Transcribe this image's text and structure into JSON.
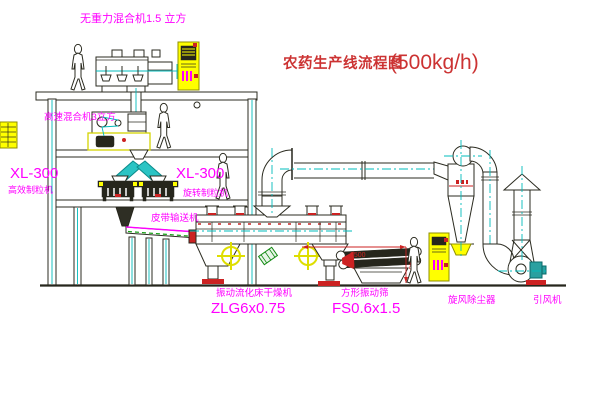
{
  "title": {
    "name": "农药生产线流程图",
    "capacity": "(500kg/h)"
  },
  "equipment_labels": {
    "gravity_mixer": "无重力混合机1.5 立方",
    "high_speed_mixer": "高速混合机3立方",
    "granulator_left_model": "XL-300",
    "granulator_left_name": "高效制粒机",
    "granulator_right_model": "XL-300",
    "granulator_right_name": "旋转制粒机",
    "belt_conveyor": "皮带输送机",
    "fluid_bed_dryer": "振动流化床干燥机",
    "fluid_bed_dryer_model": "ZLG6x0.75",
    "vibrating_screen": "方形振动筛",
    "vibrating_screen_model": "FS0.6x1.5",
    "cyclone_dust_collector": "旋风除尘器",
    "induced_draft_fan": "引风机"
  },
  "dimensions": {
    "screen_width": "2500",
    "screen_height": "340"
  },
  "colors": {
    "label_magenta": "#ff00ff",
    "title_red": "#cc3333",
    "dimension_red": "#cc2222",
    "machine_yellow": "#ffff00",
    "centerline_cyan": "#00bcbc",
    "line_dark": "#26261c",
    "motor_green": "#128a12",
    "background": "#ffffff"
  }
}
